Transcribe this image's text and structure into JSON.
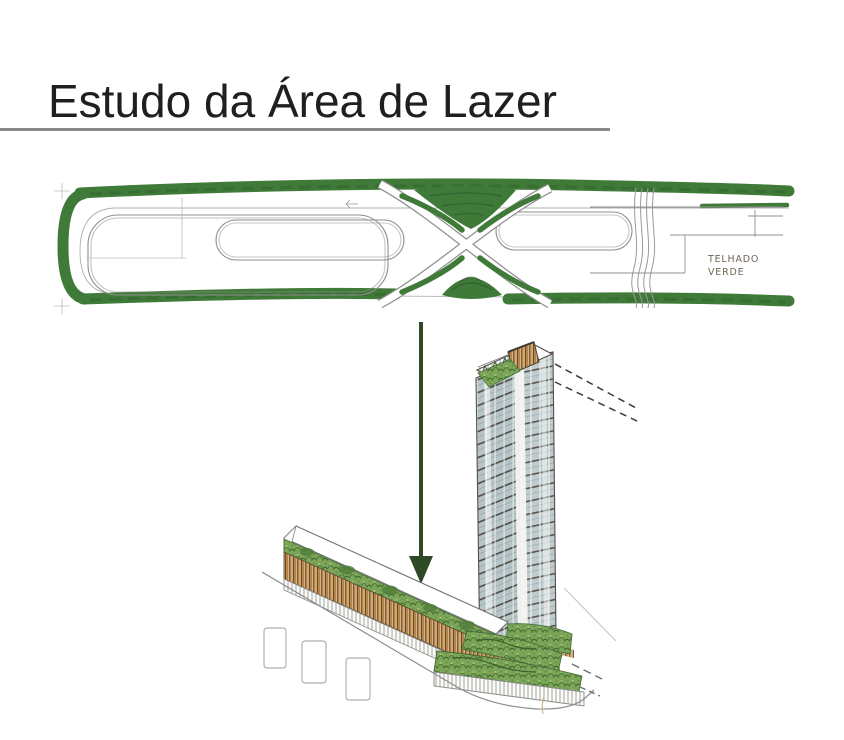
{
  "header": {
    "title": "Estudo da Área de Lazer"
  },
  "plan": {
    "annotation": {
      "line1": "TELHADO",
      "line2": "VERDE"
    }
  },
  "colors": {
    "marker_green": "#3F7A38",
    "marker_green_dark": "#336230",
    "arrow_green": "#2D4A24",
    "pencil": "#8F8F8F",
    "rule_gray": "#8A8A8A",
    "title_text": "#201E1F",
    "glass": "#B6C4C7",
    "wood": "#B5854A",
    "vegetation": "#7CA558"
  }
}
